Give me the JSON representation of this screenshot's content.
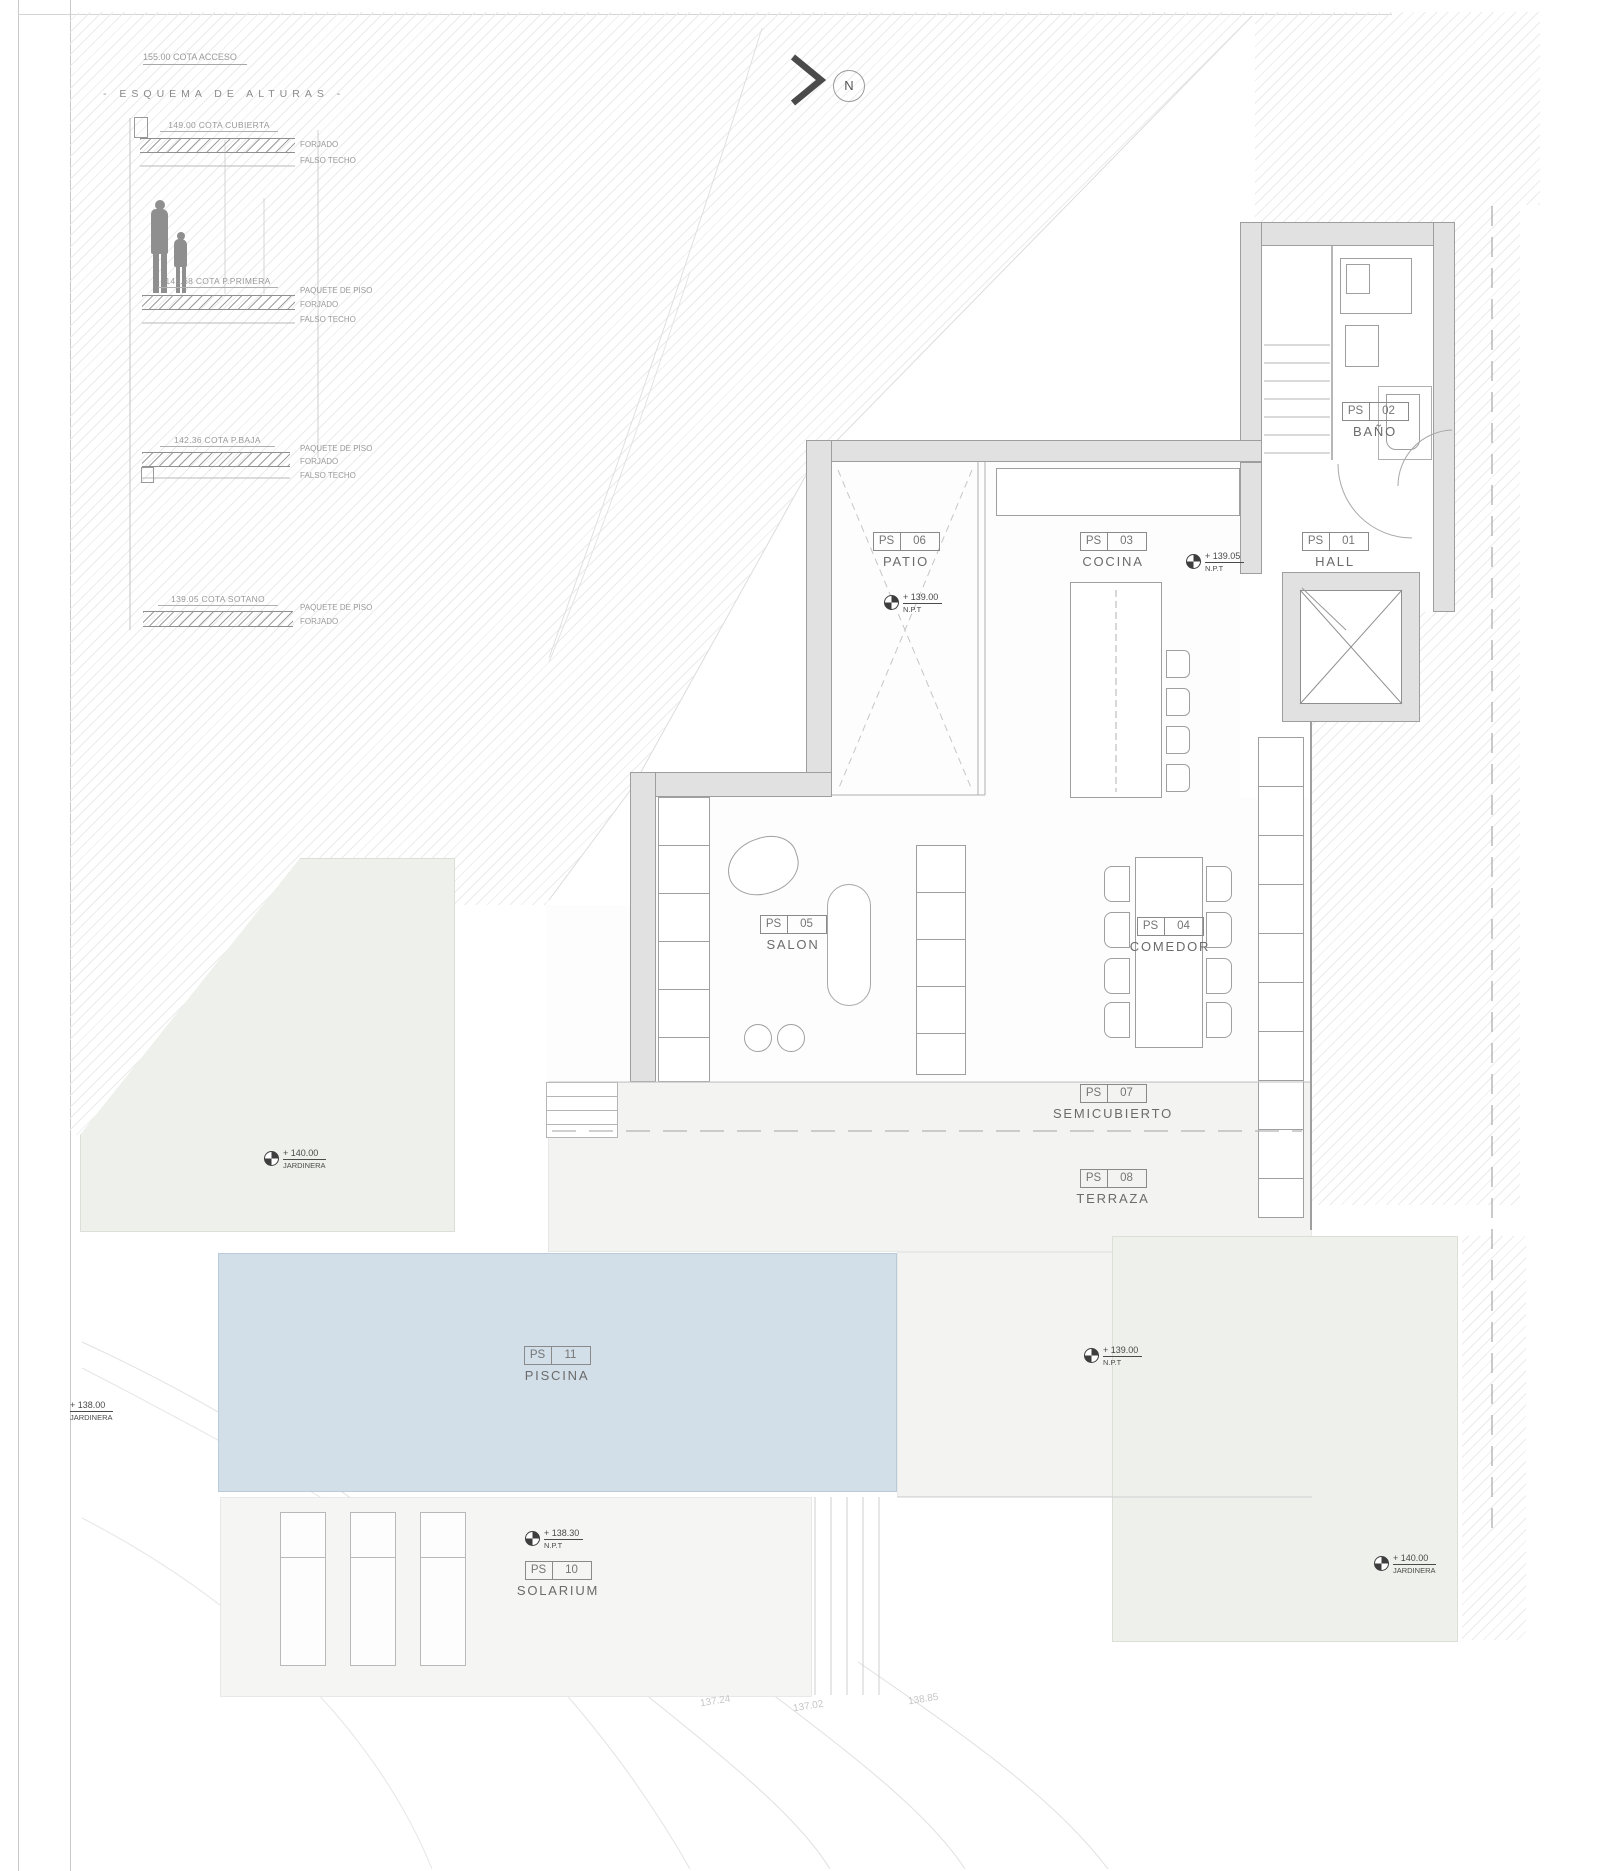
{
  "sheet": {
    "access_note": "155.00 COTA ACCESO",
    "schema_title": "- ESQUEMA DE ALTURAS -",
    "north_label": "N"
  },
  "schema": {
    "levels": [
      {
        "cota": "149.00 COTA CUBIERTA",
        "notes": [
          "FORJADO",
          "FALSO TECHO"
        ]
      },
      {
        "cota": "145.68 COTA P.PRIMERA",
        "notes": [
          "PAQUETE DE PISO",
          "FORJADO",
          "FALSO TECHO"
        ]
      },
      {
        "cota": "142.36 COTA P.BAJA",
        "notes": [
          "PAQUETE DE PISO",
          "FORJADO",
          "FALSO TECHO"
        ]
      },
      {
        "cota": "139.05 COTA SOTANO",
        "notes": [
          "PAQUETE DE PISO",
          "FORJADO"
        ]
      }
    ]
  },
  "rooms": [
    {
      "prefix": "PS",
      "number": "06",
      "name": "PATIO"
    },
    {
      "prefix": "PS",
      "number": "03",
      "name": "COCINA"
    },
    {
      "prefix": "PS",
      "number": "01",
      "name": "HALL"
    },
    {
      "prefix": "PS",
      "number": "02",
      "name": "BAÑO"
    },
    {
      "prefix": "PS",
      "number": "05",
      "name": "SALON"
    },
    {
      "prefix": "PS",
      "number": "04",
      "name": "COMEDOR"
    },
    {
      "prefix": "PS",
      "number": "07",
      "name": "SEMICUBIERTO"
    },
    {
      "prefix": "PS",
      "number": "08",
      "name": "TERRAZA"
    },
    {
      "prefix": "PS",
      "number": "11",
      "name": "PISCINA"
    },
    {
      "prefix": "PS",
      "number": "10",
      "name": "SOLARIUM"
    }
  ],
  "markers": [
    {
      "value": "+ 139.00",
      "sub": "N.P.T"
    },
    {
      "value": "+ 139.05",
      "sub": "N.P.T"
    },
    {
      "value": "+ 140.00",
      "sub": "JARDINERA"
    },
    {
      "value": "+ 138.00",
      "sub": "JARDINERA"
    },
    {
      "value": "+ 139.00",
      "sub": "N.P.T"
    },
    {
      "value": "+ 138.30",
      "sub": "N.P.T"
    },
    {
      "value": "+ 140.00",
      "sub": "JARDINERA"
    }
  ],
  "site_levels": [
    "137.24",
    "137.02",
    "138.85"
  ],
  "colors": {
    "pool": "#d2dfe9",
    "planter": "#eef1eb",
    "terrace": "#f3f4f2",
    "wall": "#e1e1e1"
  }
}
